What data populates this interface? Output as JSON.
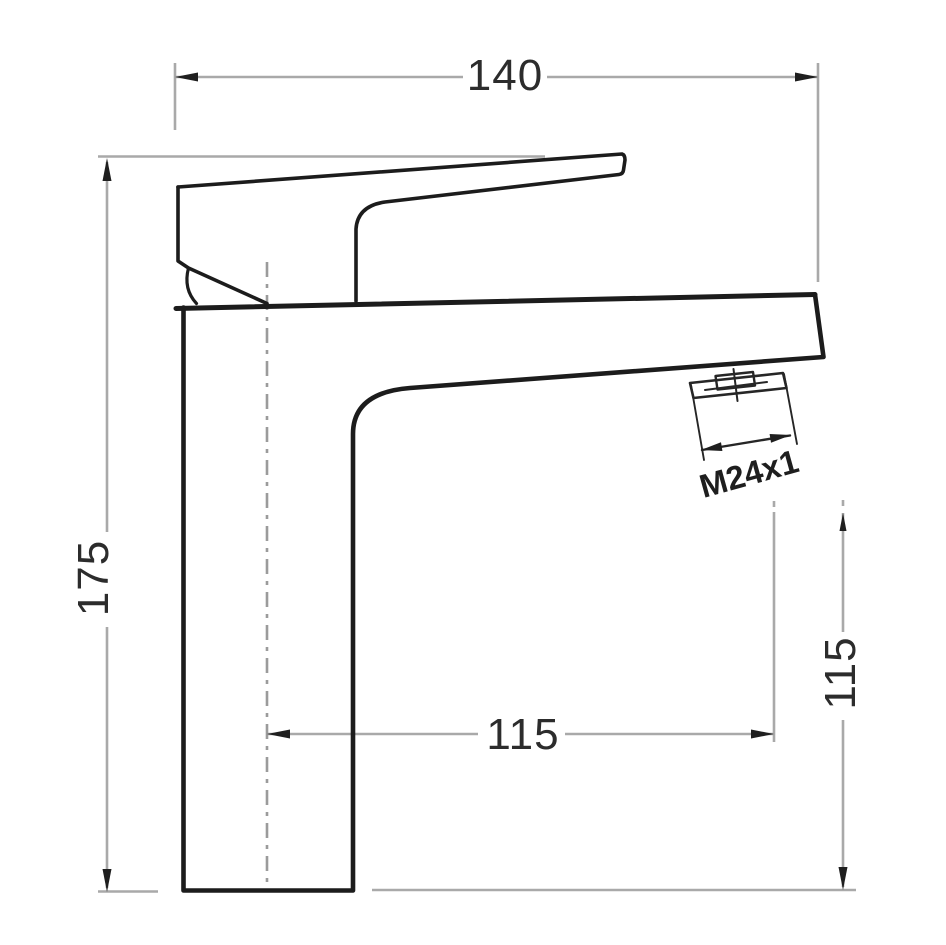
{
  "drawing": {
    "type": "technical-dimension-drawing",
    "subject": "single-lever basin mixer faucet, side elevation",
    "labels": {
      "overall_width": "140",
      "overall_height": "175",
      "spout_reach": "115",
      "outlet_height": "115",
      "aerator_thread": "M24x1"
    },
    "units": "mm (implied)",
    "colors": {
      "outline": "#1c1c1c",
      "dimension_line": "#a9a9a9",
      "centerline": "#9b9b9b",
      "arrow": "#1f1f1f",
      "text": "#2c2c2c",
      "background": "#ffffff"
    }
  }
}
